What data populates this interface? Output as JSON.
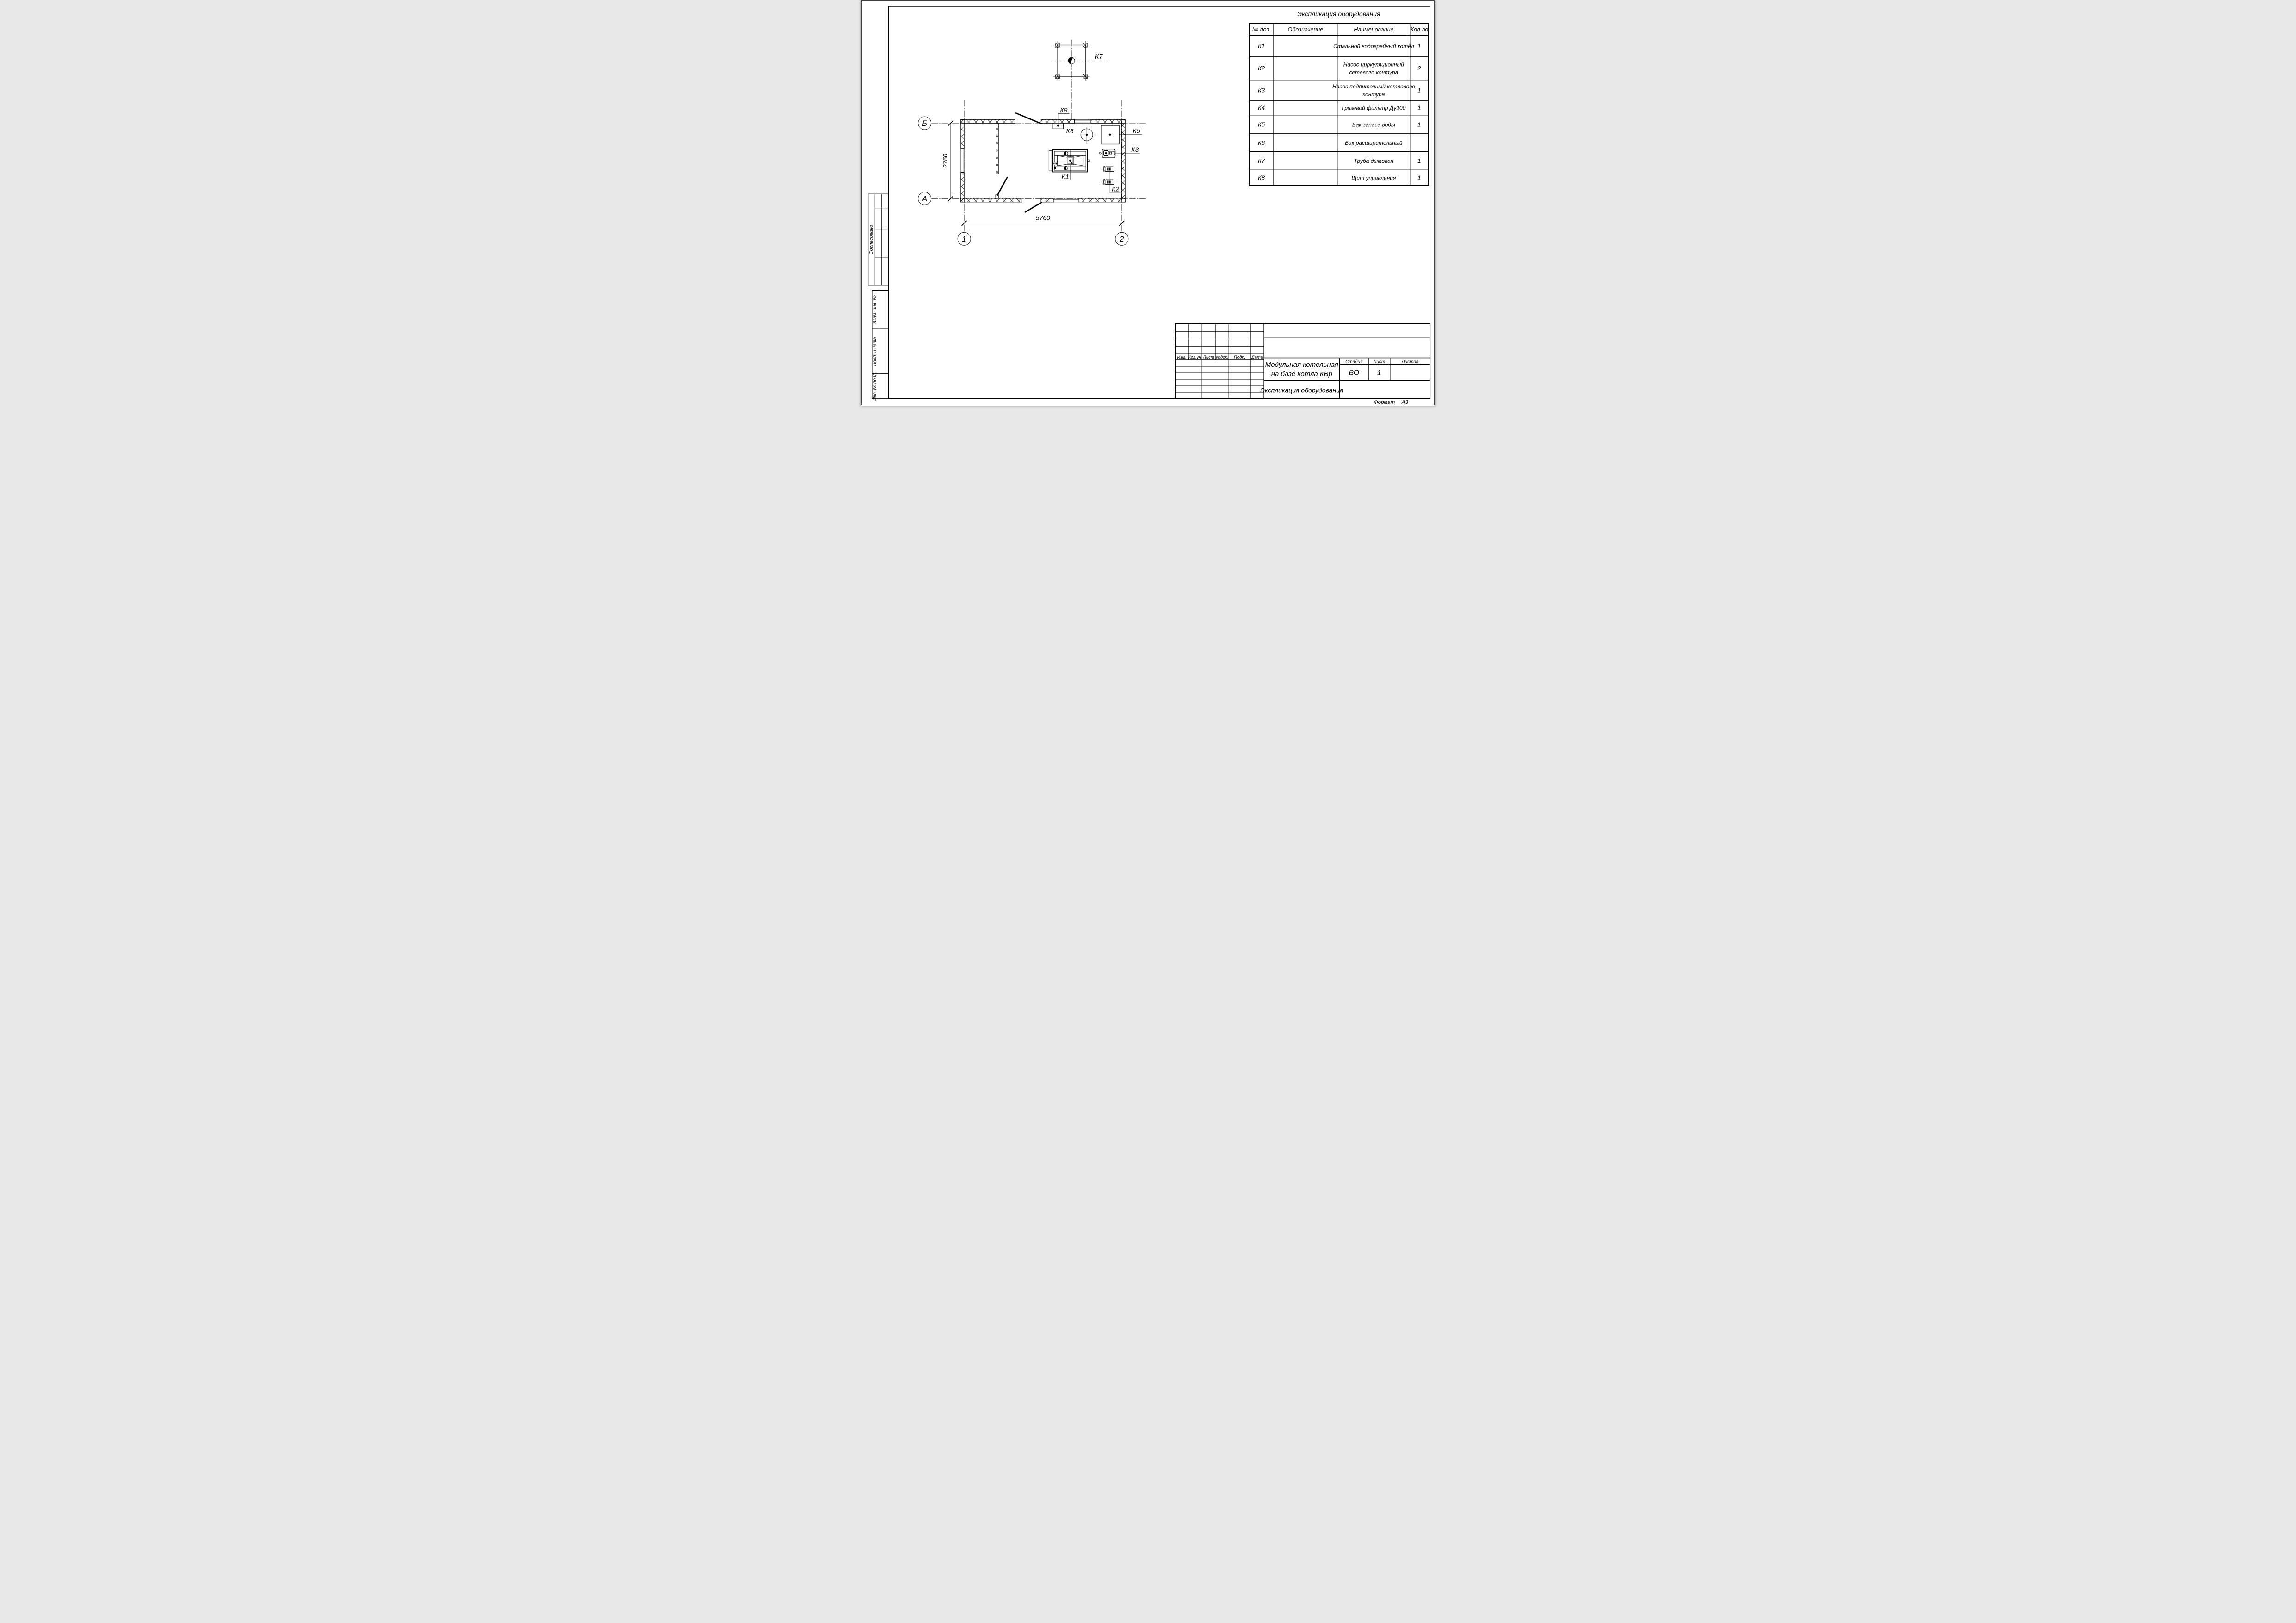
{
  "sheet": {
    "format_label": "Формат",
    "format_value": "А3"
  },
  "equipment_table": {
    "title": "Экспликация оборудования",
    "headers": {
      "pos": "№ поз.",
      "designation": "Обозначение",
      "name": "Наименование",
      "qty": "Кол-во"
    },
    "rows": [
      {
        "pos": "К1",
        "designation": "",
        "name1": "Стальной водогрейный котёл",
        "name2": "",
        "qty": "1"
      },
      {
        "pos": "К2",
        "designation": "",
        "name1": "Насос циркуляционный",
        "name2": "сетевого контура",
        "qty": "2"
      },
      {
        "pos": "К3",
        "designation": "",
        "name1": "Насос подпиточный котлового",
        "name2": "контура",
        "qty": "1"
      },
      {
        "pos": "К4",
        "designation": "",
        "name1": "Грязевой фильтр Ду100",
        "name2": "",
        "qty": "1"
      },
      {
        "pos": "К5",
        "designation": "",
        "name1": "Бак запаса воды",
        "name2": "",
        "qty": "1"
      },
      {
        "pos": "К6",
        "designation": "",
        "name1": "Бак расширительный",
        "name2": "",
        "qty": ""
      },
      {
        "pos": "К7",
        "designation": "",
        "name1": "Труба дымовая",
        "name2": "",
        "qty": "1"
      },
      {
        "pos": "К8",
        "designation": "",
        "name1": "Щит управления",
        "name2": "",
        "qty": "1"
      }
    ]
  },
  "plan": {
    "axes": {
      "b": "Б",
      "a": "А",
      "one": "1",
      "two": "2"
    },
    "dims": {
      "width": "5760",
      "height": "2760"
    },
    "labels": {
      "k1": "К1",
      "k2": "К2",
      "k3": "К3",
      "k5": "К5",
      "k6": "К6",
      "k7": "К7",
      "k8": "К8"
    }
  },
  "title_block": {
    "rev_headers": [
      "Изм.",
      "Кол.уч.",
      "Лист",
      "№док.",
      "Подп.",
      "Дата"
    ],
    "project_line1": "Модульная котельная",
    "project_line2": "на базе котла КВр",
    "doc_title": "Экспликация оборудования",
    "stage_label": "Стадия",
    "sheet_label": "Лист",
    "sheets_label": "Листов",
    "stage_value": "ВО",
    "sheet_value": "1",
    "sheets_value": ""
  },
  "side_strip": {
    "agreed": "Согласовано",
    "replace_inv": "Взам. инв. №",
    "sign_date": "Подп. и дата",
    "inv_orig": "Инв. № подл."
  }
}
